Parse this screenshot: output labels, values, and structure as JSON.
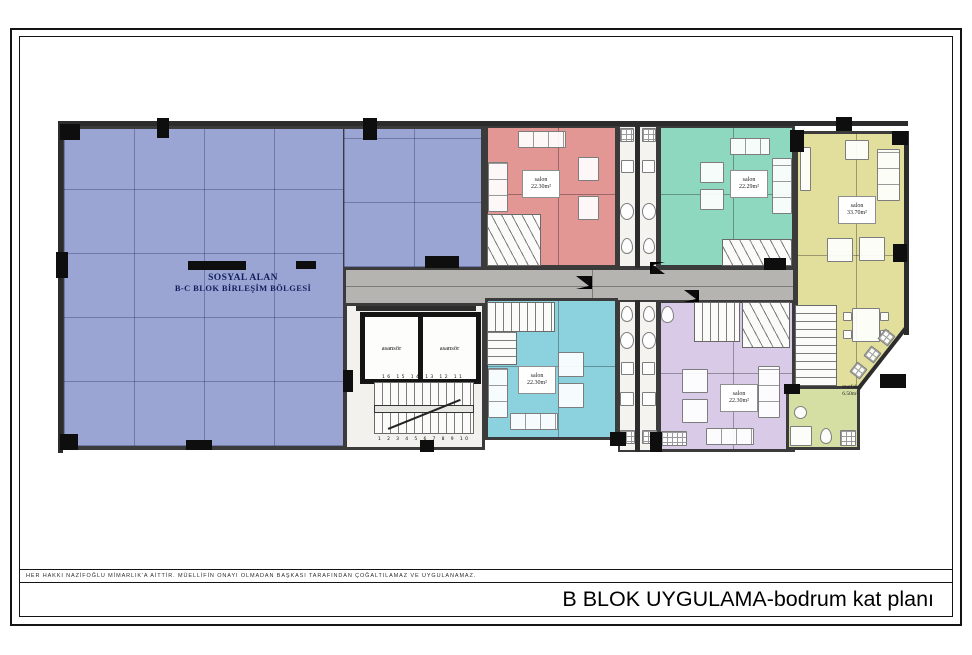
{
  "sheet": {
    "copyright": "HER HAKKI NAZİFOĞLU MİMARLIK'A AİTTİR. MÜELLİFİN ONAYI OLMADAN BAŞKASI TARAFINDAN ÇOĞALTILAMAZ VE UYGULANAMAZ.",
    "title": "B BLOK UYGULAMA-bodrum kat planı"
  },
  "plan": {
    "social_area": {
      "line1": "SOSYAL ALAN",
      "line2": "B-C BLOK BİRLEŞİM BÖLGESİ",
      "color": "#9aa5d3"
    },
    "corridor_color": "#b5b4b1",
    "core_color": "#f2f1ee",
    "rooms": {
      "salon_red": {
        "name": "salon",
        "area": "22.30m²",
        "color": "#e29795"
      },
      "salon_green": {
        "name": "salon",
        "area": "22.29m²",
        "color": "#8fd8c0"
      },
      "salon_yellow": {
        "name": "salon",
        "area": "33.70m²",
        "color": "#e2df9d"
      },
      "salon_cyan": {
        "name": "salon",
        "area": "22.30m²",
        "color": "#8cd2de"
      },
      "salon_purple": {
        "name": "salon",
        "area": "22.30m²",
        "color": "#d9cbe8"
      },
      "wc": {
        "name": "wc",
        "color": "#d6dfa3"
      },
      "kitchen": {
        "name": "mutfak",
        "area": "6.50m²"
      }
    },
    "elevators": {
      "left": "asansör",
      "right": "asansör"
    },
    "main_stair": {
      "top_numbers": "16 15 14 13 12 11",
      "bottom_numbers": "1 2 3 4 5 6 7 8 9 10"
    }
  }
}
